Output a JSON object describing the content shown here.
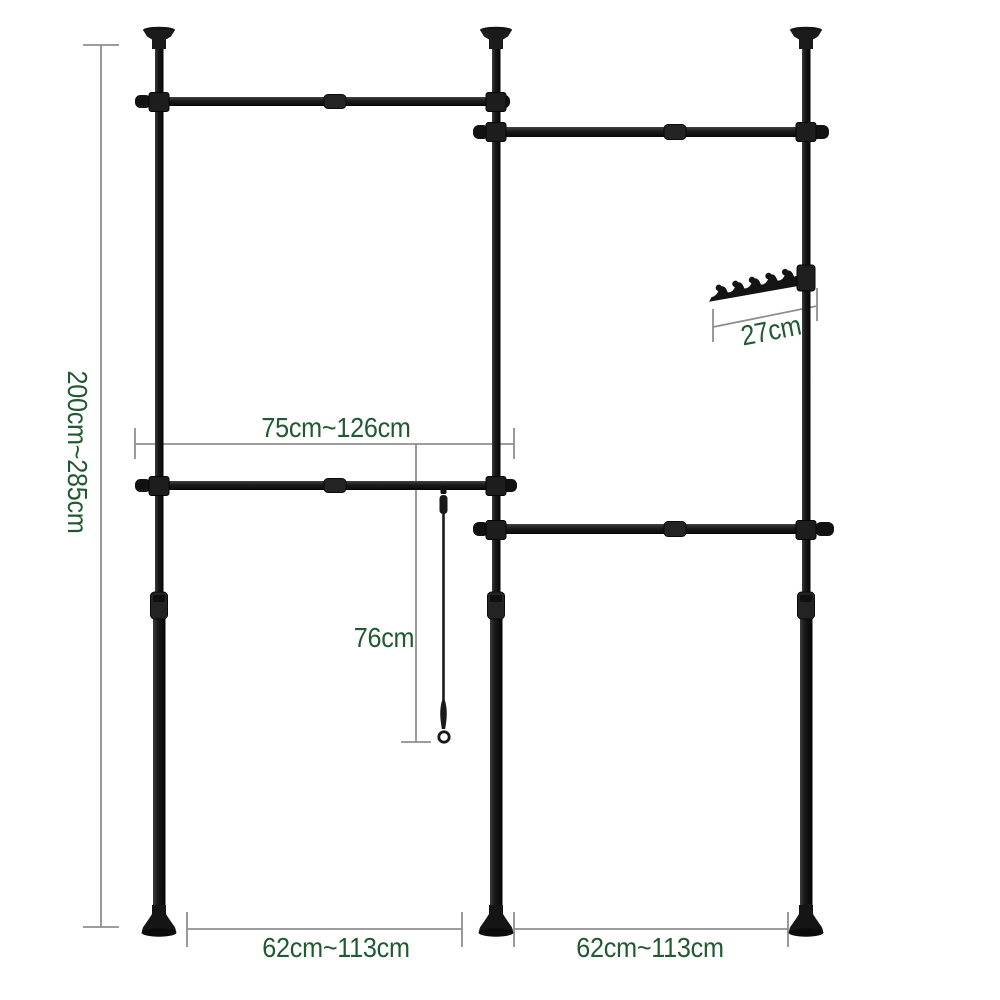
{
  "diagram": {
    "dimension_labels": {
      "total_height": "200cm~285cm",
      "upper_rail_width": "75cm~126cm",
      "strap_length": "76cm",
      "hook_bar_length": "27cm",
      "left_bay_width": "62cm~113cm",
      "right_bay_width": "62cm~113cm"
    },
    "colors": {
      "label_green": "#215a30",
      "dimension_gray": "#8f8f8f",
      "structure_black": "#161616"
    }
  }
}
